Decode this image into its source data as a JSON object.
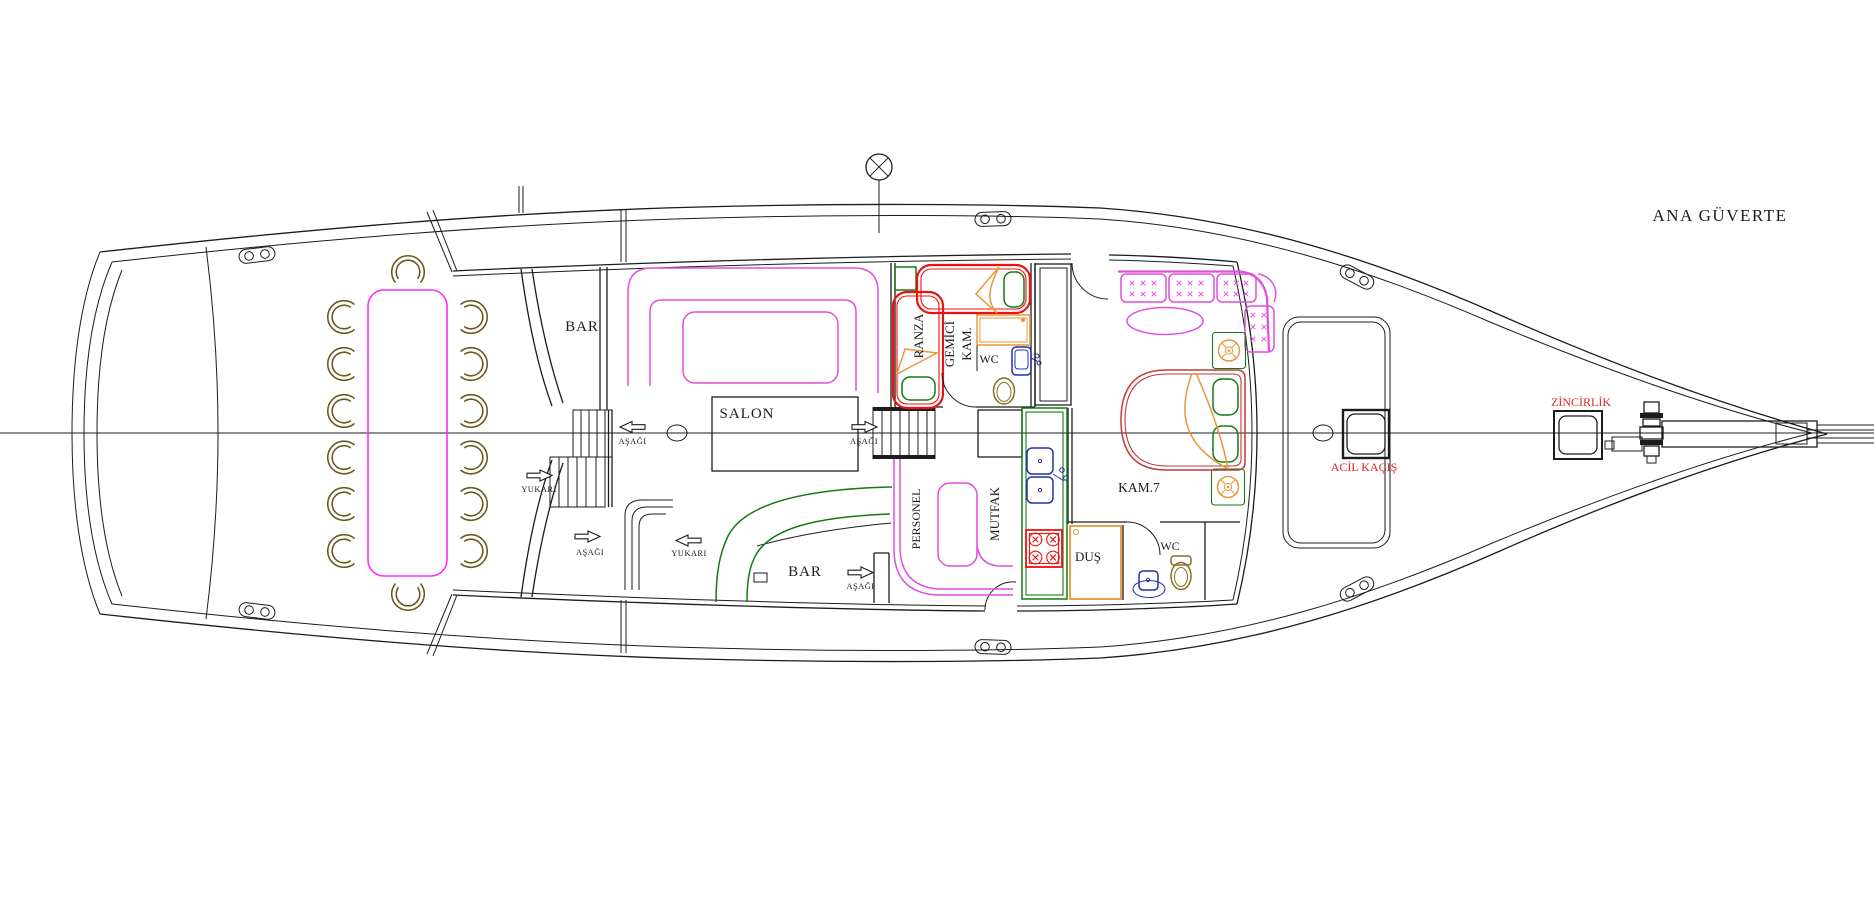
{
  "title": "ANA GÜVERTE",
  "rooms": {
    "bar_upper": "BAR",
    "salon": "SALON",
    "bar_lower": "BAR",
    "ranza": "RANZA",
    "gemici_line1": "GEMİCİ",
    "gemici_line2": "KAM.",
    "wc_crew": "WC",
    "personel": "PERSONEL",
    "mutfak": "MUTFAK",
    "dus": "DUŞ",
    "wc_lower": "WC",
    "kam7": "KAM.7"
  },
  "hatches": {
    "acil_kacis": "ACİL KAÇIŞ",
    "zincirlik": "ZİNCİRLİK"
  },
  "legend": {
    "down": "AŞAĞI",
    "up": "YUKARI"
  },
  "palette": {
    "line": "#1c1c1c",
    "magenta": "#e04fe0",
    "bright-magenta": "#ff2bff",
    "red": "#ee1111",
    "bed-red": "#c23a3a",
    "green": "#127a12",
    "orange": "#e8973a",
    "navy": "#2330a8",
    "chair-brown": "#6b5a1e",
    "toilet-brown": "#8a6d1e",
    "label-red": "#e02424"
  }
}
